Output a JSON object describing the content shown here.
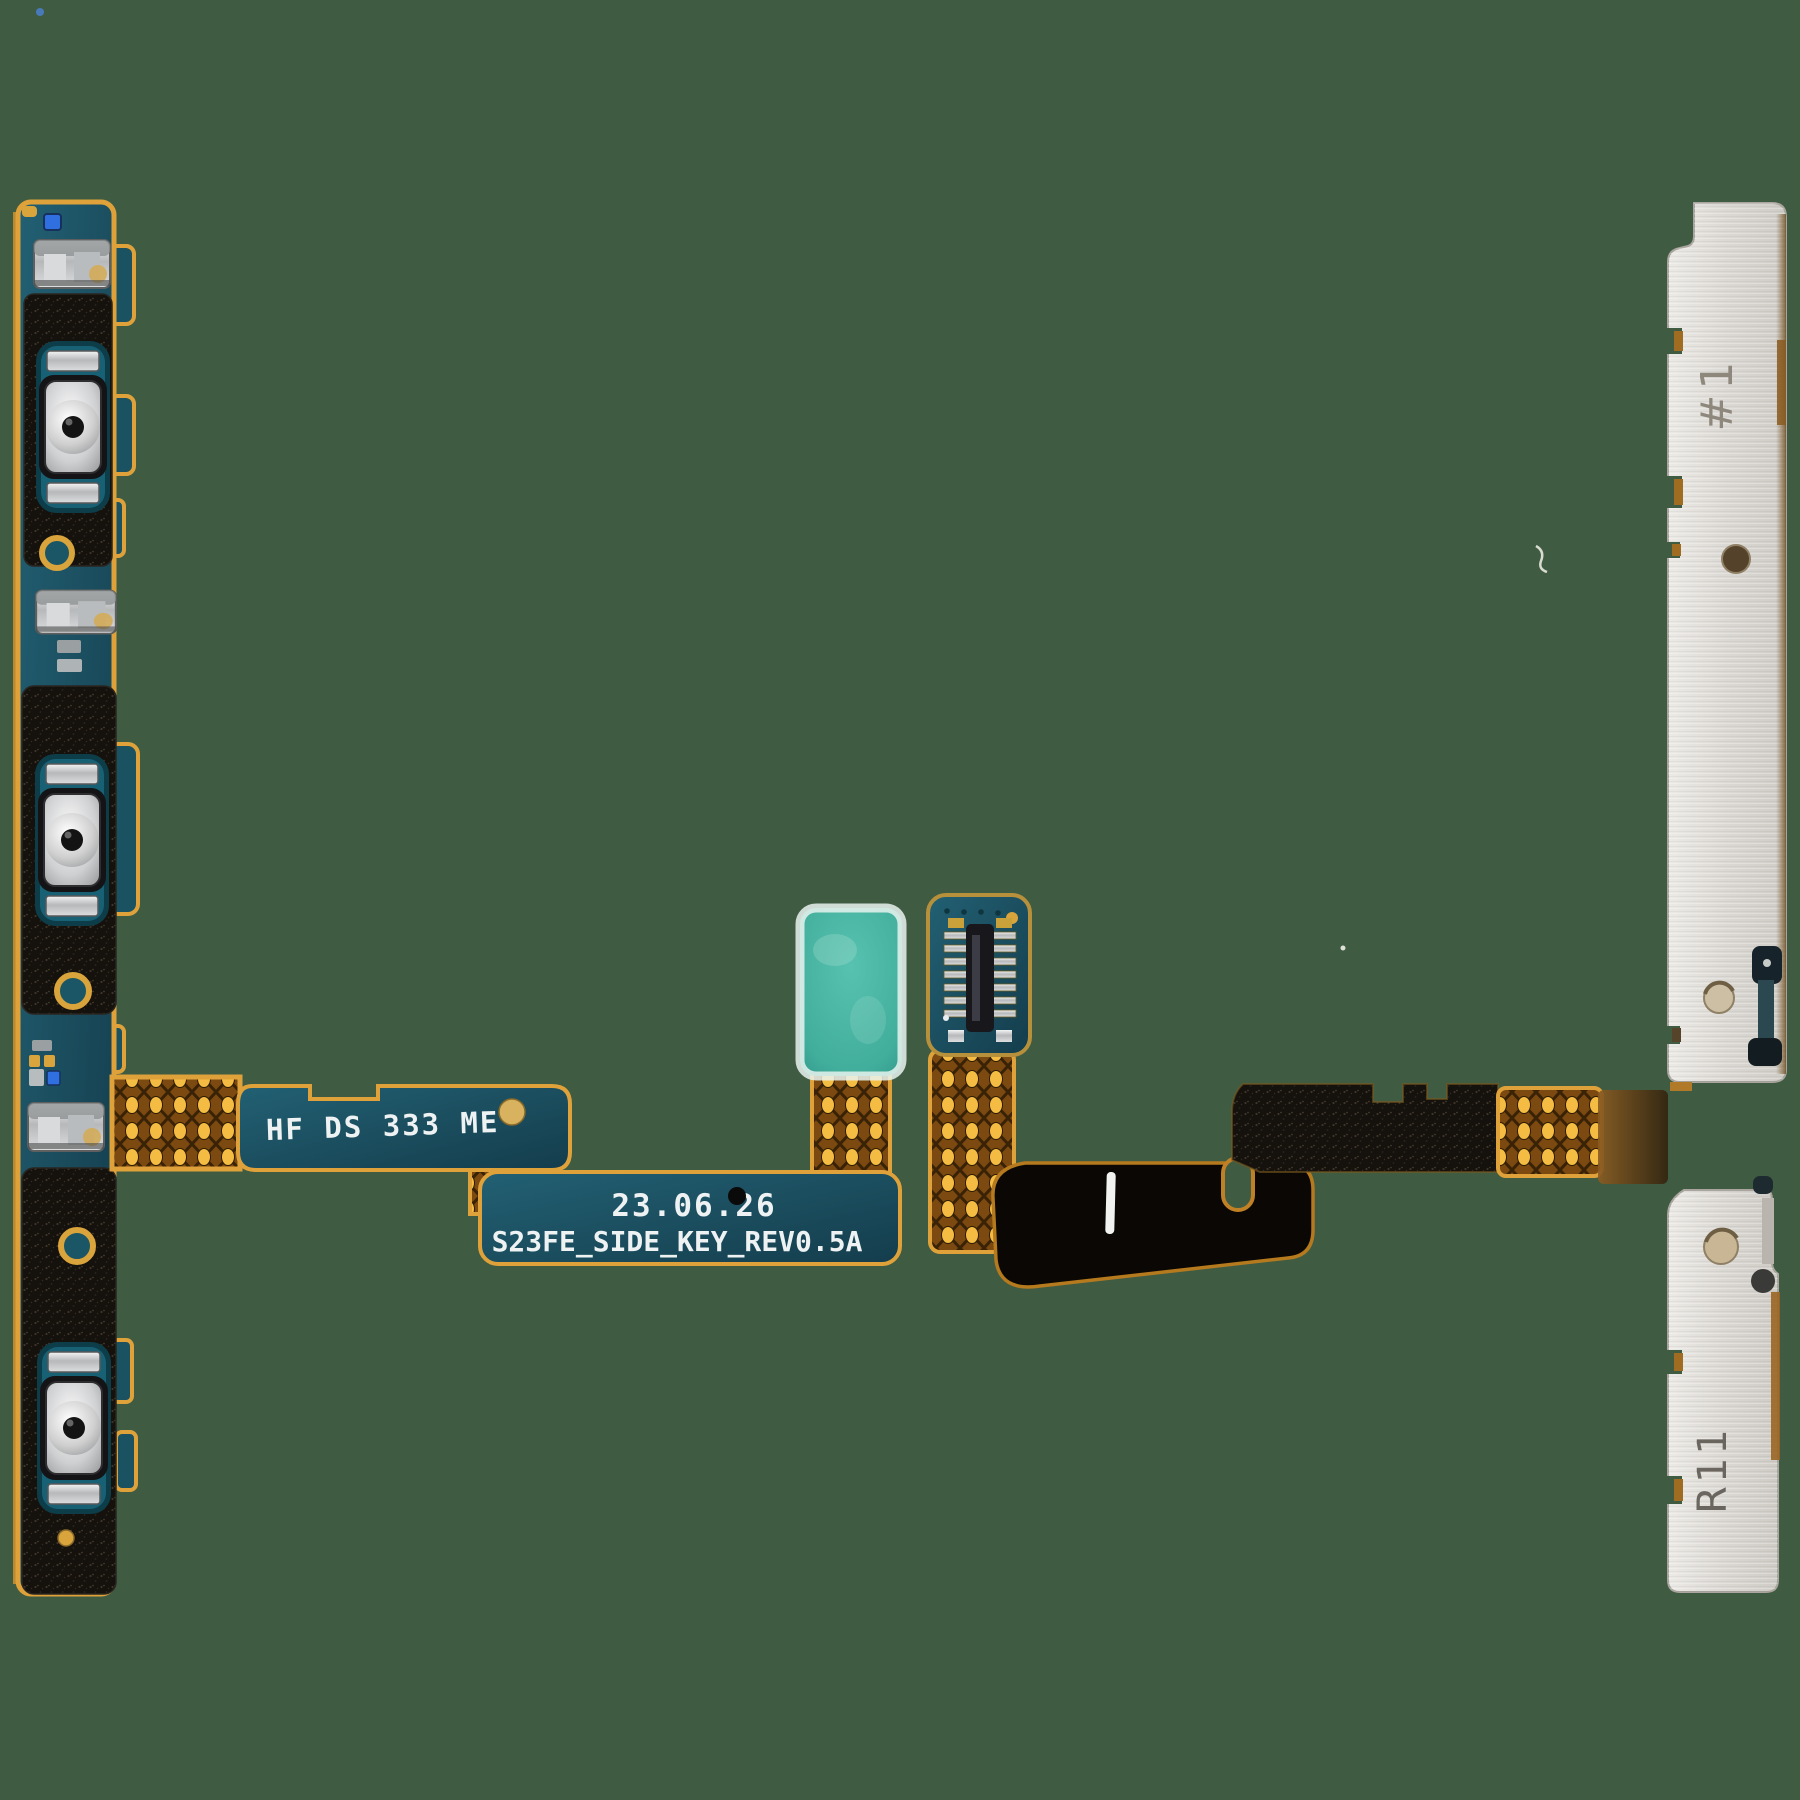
{
  "background": {
    "color": "#3f5b42"
  },
  "markings": {
    "flex_code": "HF DS 333 ME",
    "date_code": "23.06.26",
    "model_code": "S23FE_SIDE_KEY_REV0.5A",
    "bracket_top": "#1",
    "bracket_bottom": "R11"
  },
  "colors": {
    "pcb_teal": "#1d5565",
    "flex_gold_edge": "#dfa23b",
    "flex_hatch_brown": "#7c4a10",
    "flex_hatch_gold": "#f4bc42",
    "foam_black": "#16120d",
    "bracket_silver": "#dcdad5",
    "sticker_mint": "#46b3a1",
    "dome_silver": "#d9d9d9",
    "marking_text": "#eef2f2"
  }
}
